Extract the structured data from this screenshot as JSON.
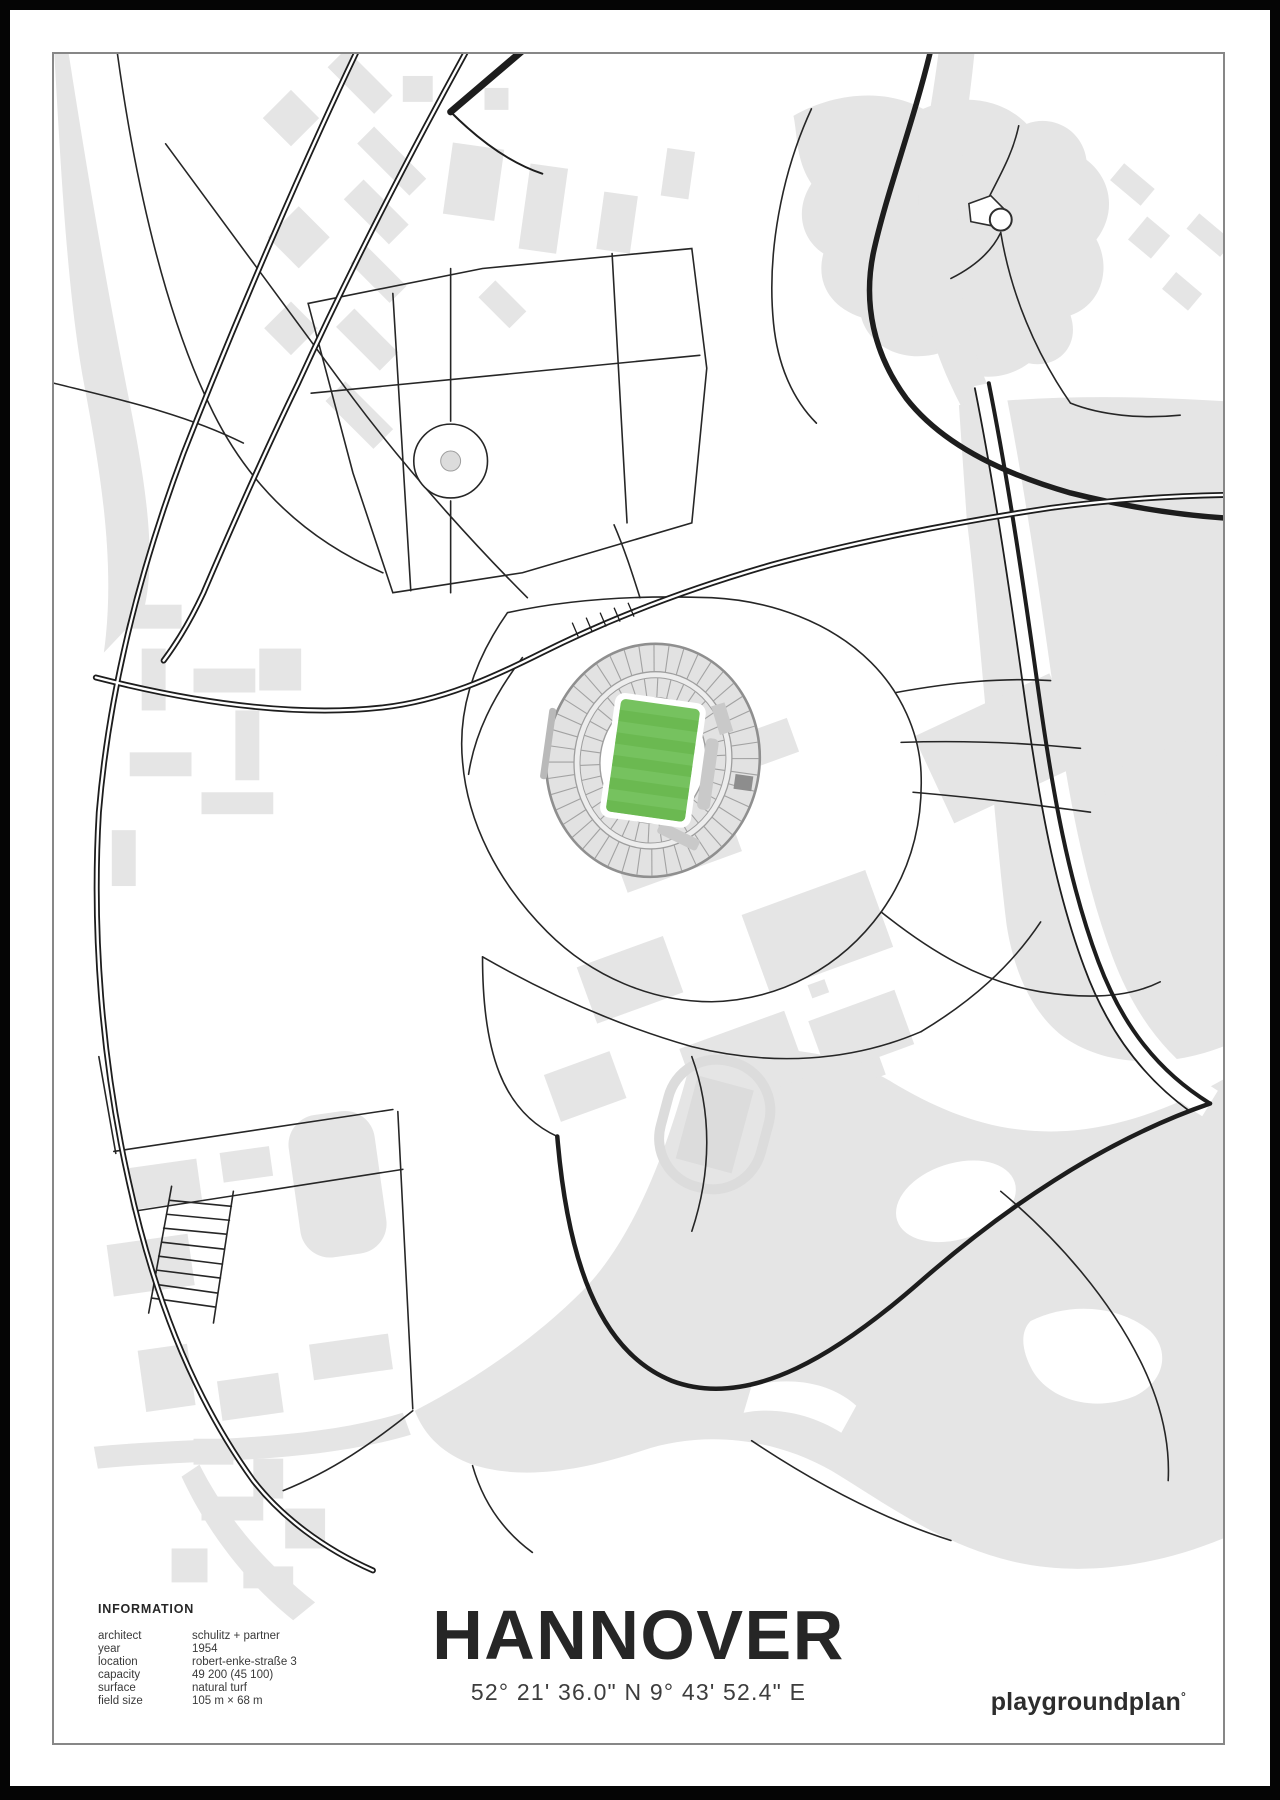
{
  "poster": {
    "title": "HANNOVER",
    "coordinates": "52° 21' 36.0\" N  9° 43' 52.4\" E",
    "brand": "playgroundplan",
    "brand_mark": "°",
    "info": {
      "heading": "INFORMATION",
      "rows": [
        {
          "label": "architect",
          "value": "schulitz + partner"
        },
        {
          "label": "year",
          "value": "1954"
        },
        {
          "label": "location",
          "value": "robert-enke-straße 3"
        },
        {
          "label": "capacity",
          "value": "49 200 (45 100)"
        },
        {
          "label": "surface",
          "value": "natural turf"
        },
        {
          "label": "field size",
          "value": "105 m × 68 m"
        }
      ]
    },
    "colors": {
      "map_gray": "#e5e5e5",
      "stand_gray": "#e2e2e2",
      "stand_line": "#9e9e9e",
      "road_black": "#1d1d1d",
      "pitch_green": "#76c25f",
      "pitch_stripe": "#6bb951",
      "frame_gray": "#878787",
      "text_dark": "#262626"
    }
  }
}
